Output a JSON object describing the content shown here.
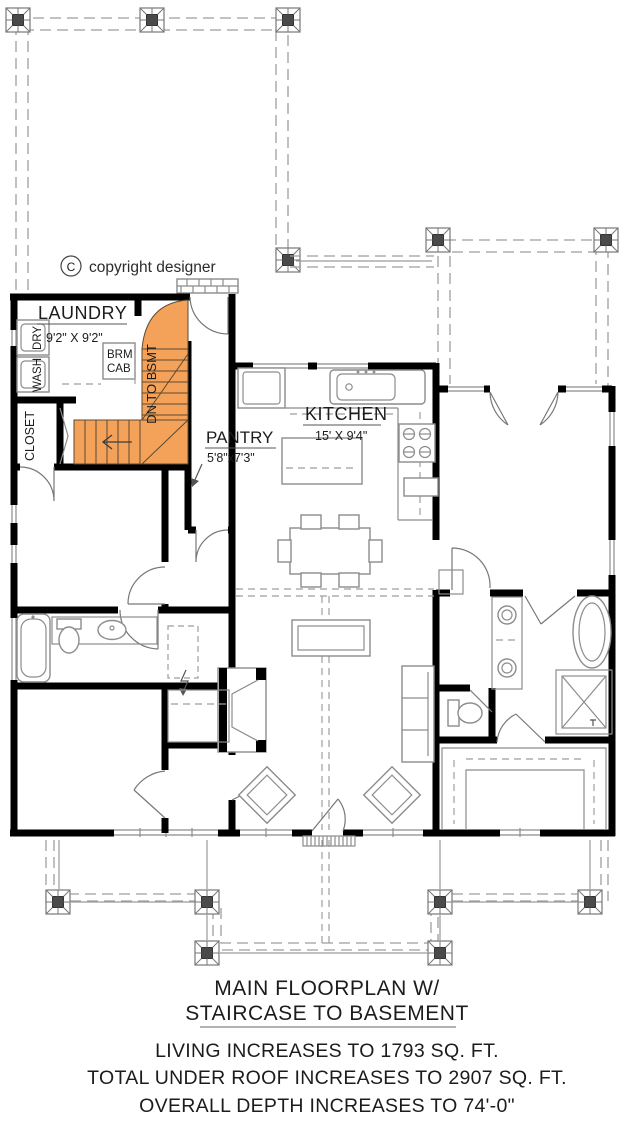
{
  "drawing": {
    "copyright": {
      "symbol": "C",
      "text": "copyright designer"
    },
    "labels": {
      "laundry": "LAUNDRY",
      "laundry_dims": "9'2\" X 9'2\"",
      "kitchen": "KITCHEN",
      "kitchen_dims": "15' X 9'4\"",
      "pantry": "PANTRY",
      "pantry_dims": "5'8\"x7'3\"",
      "closet": "CLOSET",
      "wash": "WASH",
      "dry": "DRY",
      "brm_line1": "BRM",
      "brm_line2": "CAB",
      "stairs": "DN TO BSMT"
    }
  },
  "caption": {
    "title_line1": "MAIN FLOORPLAN W/",
    "title_line2": "STAIRCASE TO BASEMENT",
    "note_living": "LIVING INCREASES TO 1793 SQ. FT.",
    "note_roof": "TOTAL UNDER ROOF INCREASES TO 2907 SQ. FT.",
    "note_depth": "OVERALL DEPTH INCREASES TO 74'-0\""
  },
  "colors": {
    "wall": "#000000",
    "stair_highlight": "#f4a259",
    "furniture_line": "#8c8c8c",
    "dashed_line": "#9e9e9e"
  }
}
